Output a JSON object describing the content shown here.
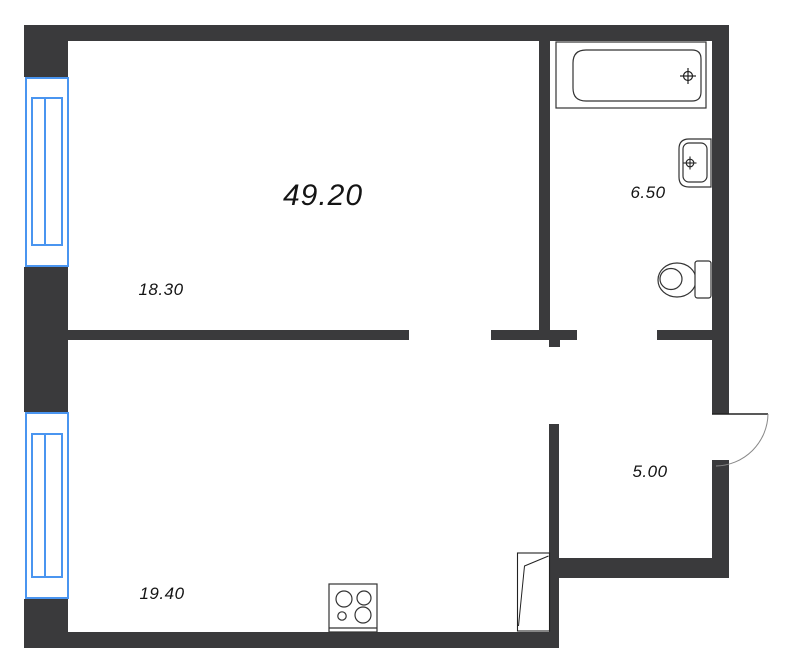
{
  "floor_plan": {
    "title": "apartment-floor-plan",
    "total_area": "49.20",
    "rooms": [
      {
        "id": "room-upper-left",
        "area": "18.30"
      },
      {
        "id": "bathroom",
        "area": "6.50"
      },
      {
        "id": "room-lower-left",
        "area": "19.40"
      },
      {
        "id": "hallway",
        "area": "5.00"
      }
    ],
    "fixtures": [
      {
        "name": "bathtub"
      },
      {
        "name": "sink"
      },
      {
        "name": "toilet"
      },
      {
        "name": "stove"
      },
      {
        "name": "entrance-door"
      },
      {
        "name": "interior-door"
      },
      {
        "name": "window-upper"
      },
      {
        "name": "window-lower"
      }
    ],
    "colors": {
      "wall": "#3a3a3c",
      "window": "#4a95f0",
      "line": "#333333",
      "text": "#141414",
      "background": "#ffffff"
    }
  }
}
